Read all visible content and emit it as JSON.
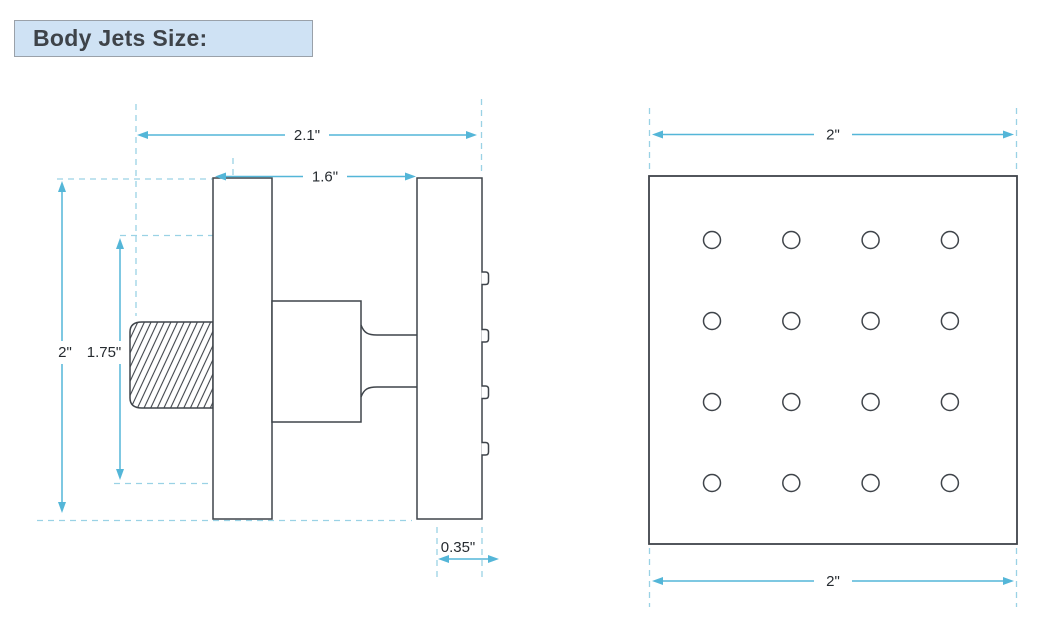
{
  "title": {
    "text": "Body Jets Size:"
  },
  "side_view": {
    "label": "body jet side view",
    "dimensions": {
      "overall_depth": "2.1\"",
      "body_depth": "1.6\"",
      "overall_height": "2\"",
      "inner_height": "1.75\"",
      "faceplate_thickness": "0.35\""
    }
  },
  "front_view": {
    "label": "body jet front view",
    "dimensions": {
      "width_top": "2\"",
      "width_bottom": "2\""
    },
    "nozzle_grid": {
      "rows": 4,
      "cols": 4,
      "total_holes": 16
    }
  },
  "colors": {
    "outline": "#3f444a",
    "dim": "#54b6d8",
    "ext": "#9ad2e5",
    "ink": "#262b30",
    "title-bg": "#cfe2f4",
    "title-border": "#9aa1a9",
    "title-ink": "#3e4349"
  }
}
